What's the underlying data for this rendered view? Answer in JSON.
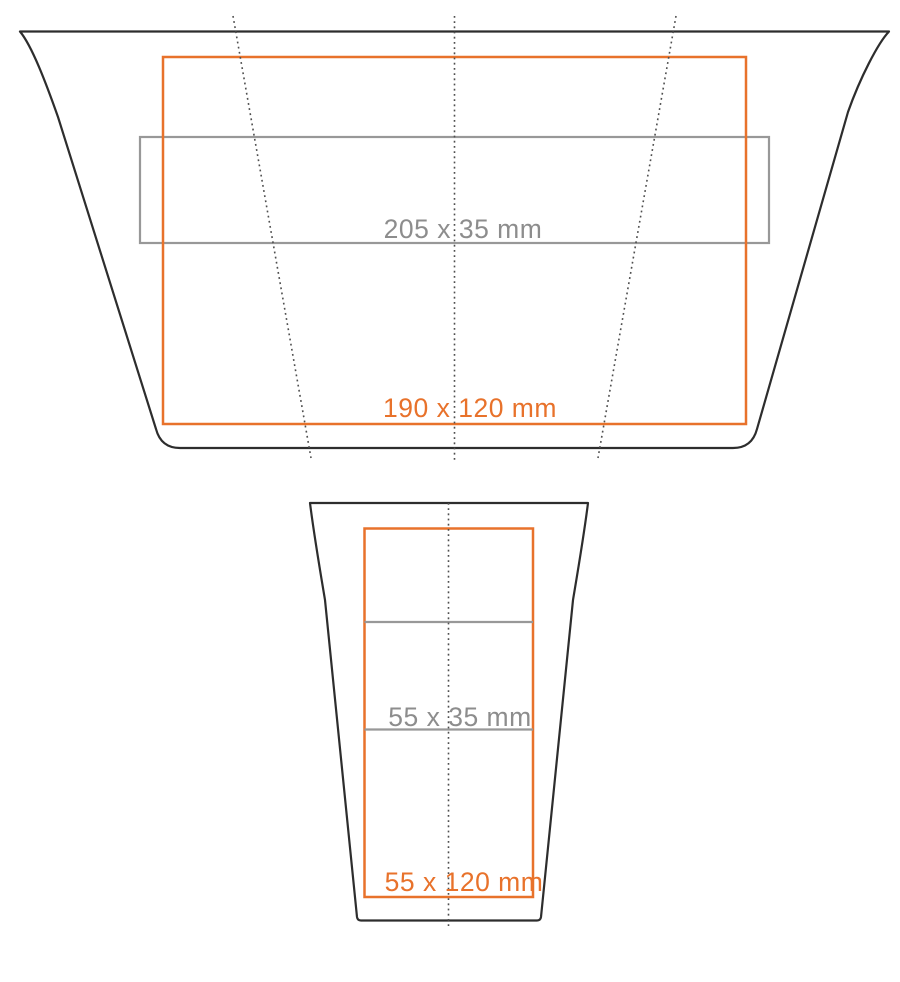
{
  "diagram": {
    "top_view": {
      "wrap_area_label": "190 x 120 mm",
      "band_area_label": "205 x 35 mm"
    },
    "side_view": {
      "wrap_area_label": "55 x 120 mm",
      "band_area_label": "55 x 35 mm"
    }
  },
  "colors": {
    "background": "#ffffff",
    "outline": "#2d2d2d",
    "wrap_accent": "#e8722b",
    "band_gray": "#989898",
    "band_text_gray": "#8d8d8d",
    "fold_line": "#4f4f4f"
  }
}
